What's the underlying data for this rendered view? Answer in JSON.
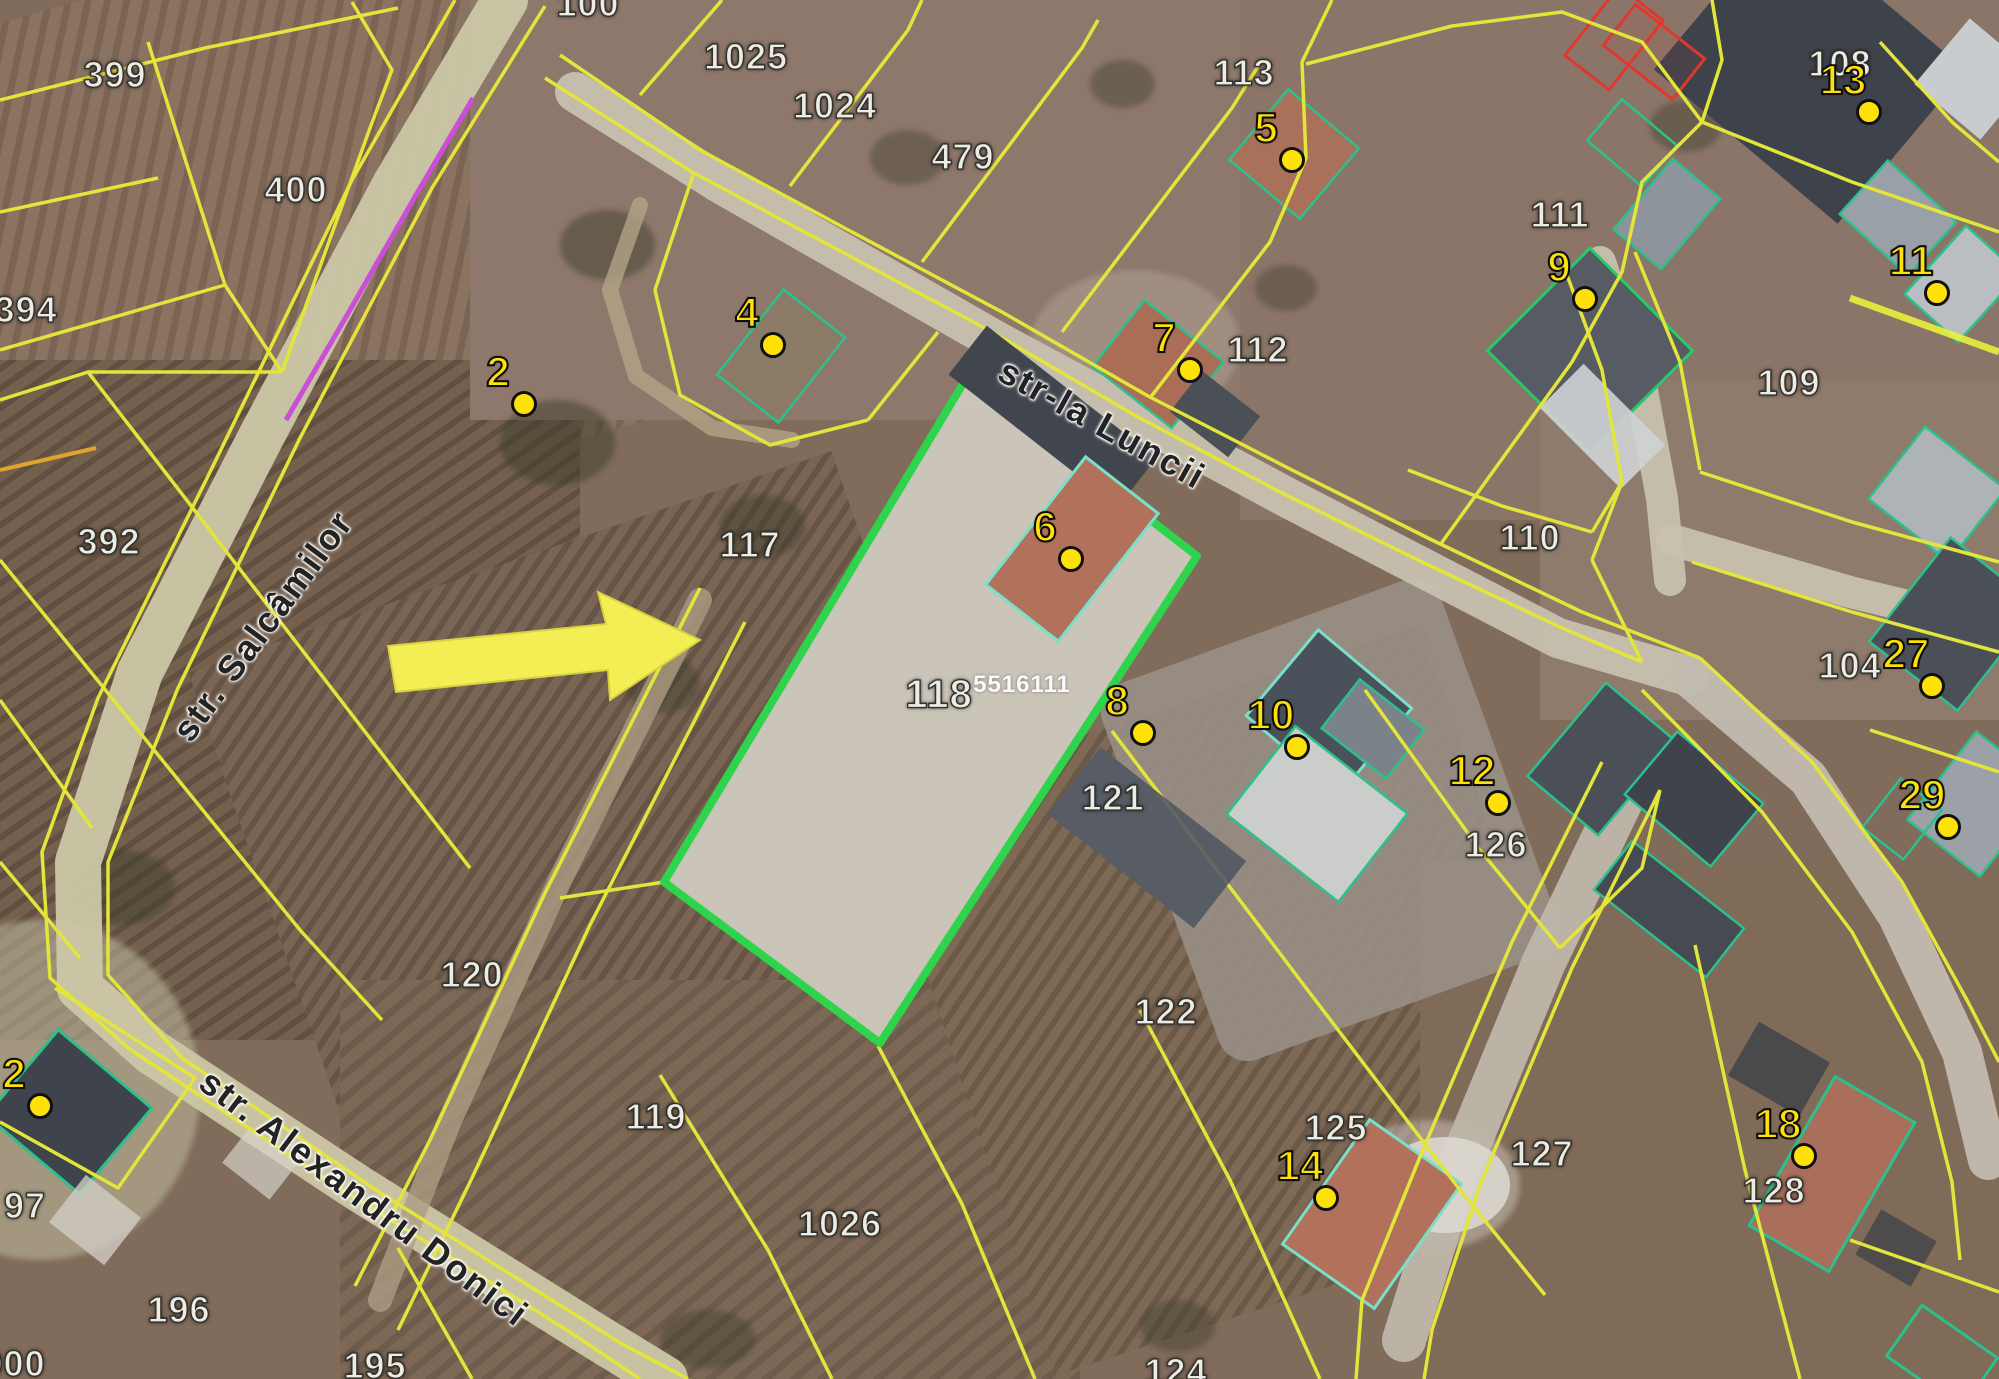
{
  "map": {
    "title": "cadastral-satellite-view",
    "colors": {
      "parcel_boundary": "#e3e53b",
      "highlight_parcel": "#2ed44b",
      "building_outline": "#2cc08c",
      "building_outline_light": "#7adfc8",
      "restricted_outline": "#e0382c",
      "marker": "#ffe10a",
      "arrow": "#f3ee54",
      "survey_line": "#c94fd6"
    },
    "highlighted_parcel": {
      "number": "118",
      "cadastral_code": "5516111"
    },
    "streets": [
      {
        "name": "str. Salcâmilor",
        "x": 263,
        "y": 626,
        "rotation": -53.5,
        "size": 36
      },
      {
        "name": "str-la Luncii",
        "x": 1102,
        "y": 424,
        "rotation": 29,
        "size": 36
      },
      {
        "name": "str. Alexandru Donici",
        "x": 364,
        "y": 1198,
        "rotation": 37,
        "size": 36
      }
    ],
    "parcels": [
      {
        "number": "399",
        "x": 115,
        "y": 75
      },
      {
        "number": "400",
        "x": 296,
        "y": 190
      },
      {
        "number": "394",
        "x": 26,
        "y": 310
      },
      {
        "number": "392",
        "x": 109,
        "y": 542
      },
      {
        "number": "100",
        "x": 588,
        "y": 4
      },
      {
        "number": "1025",
        "x": 746,
        "y": 57
      },
      {
        "number": "1024",
        "x": 835,
        "y": 106
      },
      {
        "number": "479",
        "x": 963,
        "y": 157
      },
      {
        "number": "113",
        "x": 1244,
        "y": 73
      },
      {
        "number": "112",
        "x": 1258,
        "y": 350
      },
      {
        "number": "111",
        "x": 1560,
        "y": 215
      },
      {
        "number": "108",
        "x": 1840,
        "y": 64
      },
      {
        "number": "109",
        "x": 1789,
        "y": 383
      },
      {
        "number": "110",
        "x": 1530,
        "y": 538
      },
      {
        "number": "117",
        "x": 750,
        "y": 545
      },
      {
        "number": "118",
        "x": 939,
        "y": 695,
        "size": 40
      },
      {
        "number": "5516111",
        "x": 1022,
        "y": 685,
        "code": true
      },
      {
        "number": "121",
        "x": 1113,
        "y": 798
      },
      {
        "number": "122",
        "x": 1166,
        "y": 1012
      },
      {
        "number": "126",
        "x": 1496,
        "y": 845
      },
      {
        "number": "104",
        "x": 1850,
        "y": 666
      },
      {
        "number": "120",
        "x": 472,
        "y": 975
      },
      {
        "number": "119",
        "x": 656,
        "y": 1117
      },
      {
        "number": "1026",
        "x": 840,
        "y": 1224
      },
      {
        "number": "125",
        "x": 1336,
        "y": 1128
      },
      {
        "number": "127",
        "x": 1542,
        "y": 1154
      },
      {
        "number": "128",
        "x": 1774,
        "y": 1191
      },
      {
        "number": "196",
        "x": 179,
        "y": 1310
      },
      {
        "number": "97",
        "x": 25,
        "y": 1206
      },
      {
        "number": "195",
        "x": 375,
        "y": 1366
      },
      {
        "number": "124",
        "x": 1176,
        "y": 1372
      },
      {
        "number": "000",
        "x": 14,
        "y": 1364
      }
    ],
    "markers": [
      {
        "label": "2",
        "x": 524,
        "y": 404
      },
      {
        "label": "4",
        "x": 773,
        "y": 345
      },
      {
        "label": "5",
        "x": 1292,
        "y": 160
      },
      {
        "label": "6",
        "x": 1071,
        "y": 559
      },
      {
        "label": "7",
        "x": 1190,
        "y": 370
      },
      {
        "label": "8",
        "x": 1143,
        "y": 733
      },
      {
        "label": "9",
        "x": 1585,
        "y": 299
      },
      {
        "label": "10",
        "x": 1297,
        "y": 747
      },
      {
        "label": "11",
        "x": 1937,
        "y": 293
      },
      {
        "label": "12",
        "x": 1498,
        "y": 803
      },
      {
        "label": "13",
        "x": 1869,
        "y": 112
      },
      {
        "label": "14",
        "x": 1326,
        "y": 1198
      },
      {
        "label": "18",
        "x": 1804,
        "y": 1156
      },
      {
        "label": "27",
        "x": 1932,
        "y": 686
      },
      {
        "label": "29",
        "x": 1948,
        "y": 827
      },
      {
        "label": "2",
        "x": 40,
        "y": 1106
      }
    ]
  }
}
